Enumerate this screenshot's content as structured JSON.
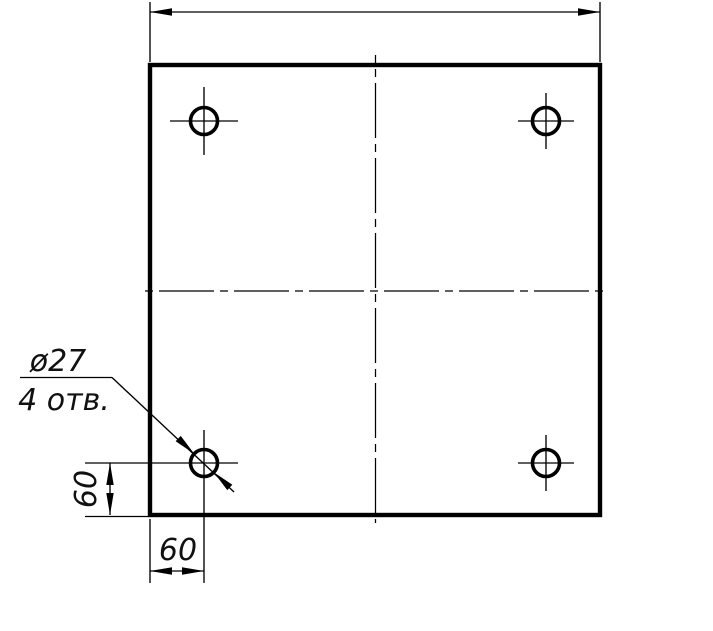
{
  "drawing": {
    "kind": "engineering-drawing-plate-with-4-holes",
    "annotations": {
      "hole_callout": {
        "diameter": "ø27",
        "count": "4 отв."
      },
      "dim_offset_left": "60",
      "dim_offset_bottom": "60"
    },
    "colors": {
      "ink": "#000000",
      "paper": "#ffffff"
    }
  }
}
